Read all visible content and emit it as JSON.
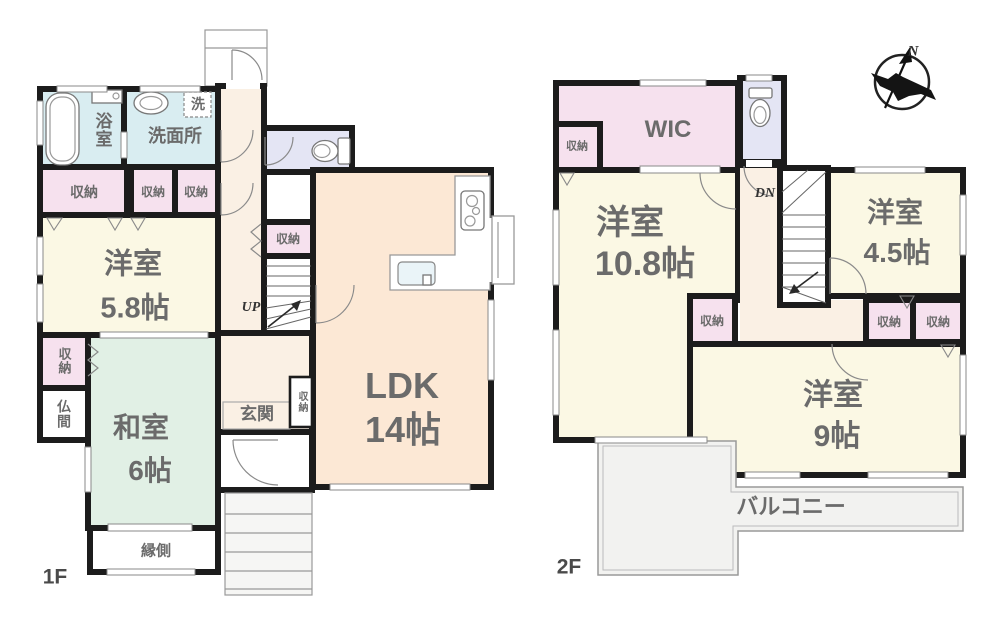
{
  "colors": {
    "wall": "#1c1c1c",
    "bath_blue": "#d9edf1",
    "closet_pink": "#f6e1ee",
    "room_cream": "#fbf8e4",
    "tatami_green": "#e1f0e5",
    "ldk_peach": "#fce8d5",
    "toilet_lavender": "#e4e5f4",
    "hall_cream": "#faf0e4",
    "outdoor_gray": "#f2f2f0",
    "label_gray": "#6b6b6b",
    "white": "#ffffff"
  },
  "compass": {
    "north_label": "N"
  },
  "floor1": {
    "label": "1F",
    "bathroom": "浴室",
    "washroom": "洗面所",
    "laundry": "洗",
    "storage": "収納",
    "western_room": {
      "name": "洋室",
      "size": "5.8帖"
    },
    "butsuma": "仏間",
    "japanese_room": {
      "name": "和室",
      "size": "6帖"
    },
    "engawa": "縁側",
    "entrance": "玄関",
    "stairs_up": "UP",
    "ldk": {
      "name": "LDK",
      "size": "14帖"
    }
  },
  "floor2": {
    "label": "2F",
    "wic": "WIC",
    "storage": "収納",
    "stairs_down": "DN",
    "western_room_large": {
      "name": "洋室",
      "size": "10.8帖"
    },
    "western_room_small": {
      "name": "洋室",
      "size": "4.5帖"
    },
    "western_room_mid": {
      "name": "洋室",
      "size": "9帖"
    },
    "balcony": "バルコニー"
  }
}
